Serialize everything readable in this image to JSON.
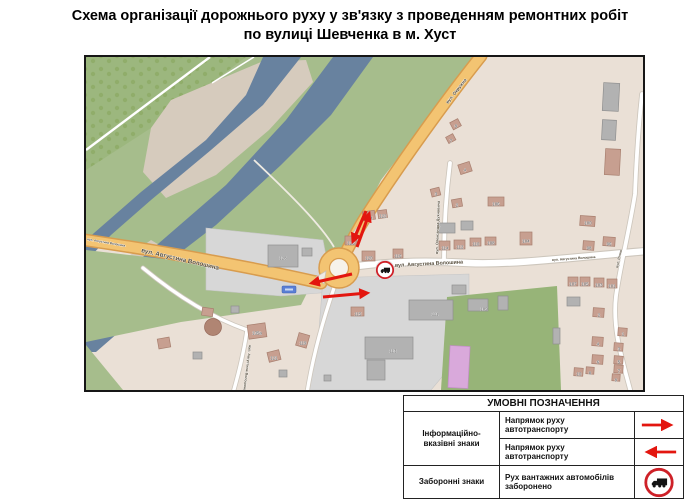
{
  "title": {
    "line1": "Схема організації дорожнього руху у зв'язку з проведенням ремонтних робіт",
    "line2": "по вулиці Шевченка в м. Хуст"
  },
  "map": {
    "street_labels": [
      {
        "text": "вул. Окружна"
      },
      {
        "text": "вул. Августина Волошина"
      },
      {
        "text": "вул. Августина Волошина"
      },
      {
        "text": "вул. Августина Волошина"
      },
      {
        "text": "вул. Олександра Духновича"
      },
      {
        "text": "вул. Августина Волошина"
      },
      {
        "text": "вул. Річна"
      },
      {
        "text": "вул. Августина Волошина"
      }
    ],
    "building_numbers": [
      "128",
      "126",
      "124",
      "122",
      "120",
      "116",
      "114",
      "112",
      "110",
      "108",
      "106",
      "104",
      "100",
      "98",
      "96",
      "3",
      "2",
      "4",
      "9",
      "7",
      "107",
      "105",
      "103",
      "101",
      "135а",
      "121",
      "119",
      "115",
      "111",
      "113",
      "109",
      "2",
      "1",
      "4",
      "3",
      "6",
      "5",
      "10",
      "8",
      "7",
      "9"
    ],
    "icons": {
      "no_trucks_sign": "no-trucks-sign",
      "route_shield": "route-shield"
    },
    "colors": {
      "road_main": "#F3C472",
      "river": "#68829F",
      "arrow_red": "#E3160F",
      "sign_ring": "#CE2128"
    }
  },
  "legend": {
    "header": "УМОВНІ ПОЗНАЧЕННЯ",
    "col1_rows12": "Інформаційно-вказівні знаки",
    "col1_row3": "Заборонні знаки",
    "row1_desc": "Напрямок руху автотранспорту",
    "row2_desc": "Напрямок руху автотранспорту",
    "row3_desc": "Рух вантажних автомобілів заборонено"
  }
}
